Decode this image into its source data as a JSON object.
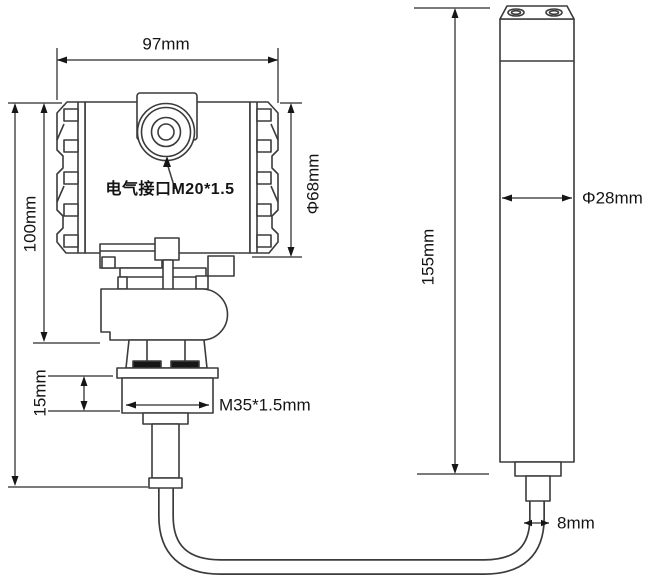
{
  "diagram": {
    "kind": "technical-dimension-drawing",
    "labels": {
      "head_width": "97mm",
      "head_height": "100mm",
      "head_diameter": "Φ68mm",
      "electrical_port": "电气接口M20*1.5",
      "nut_height": "15mm",
      "thread_spec": "M35*1.5mm",
      "probe_length": "155mm",
      "probe_diameter": "Φ28mm",
      "cable_diameter": "8mm"
    },
    "colors": {
      "background": "#ffffff",
      "part_outline": "#3b3b3b",
      "dimension_line": "#4f4f4f",
      "arrowhead": "#161616",
      "text": "#141414"
    }
  }
}
